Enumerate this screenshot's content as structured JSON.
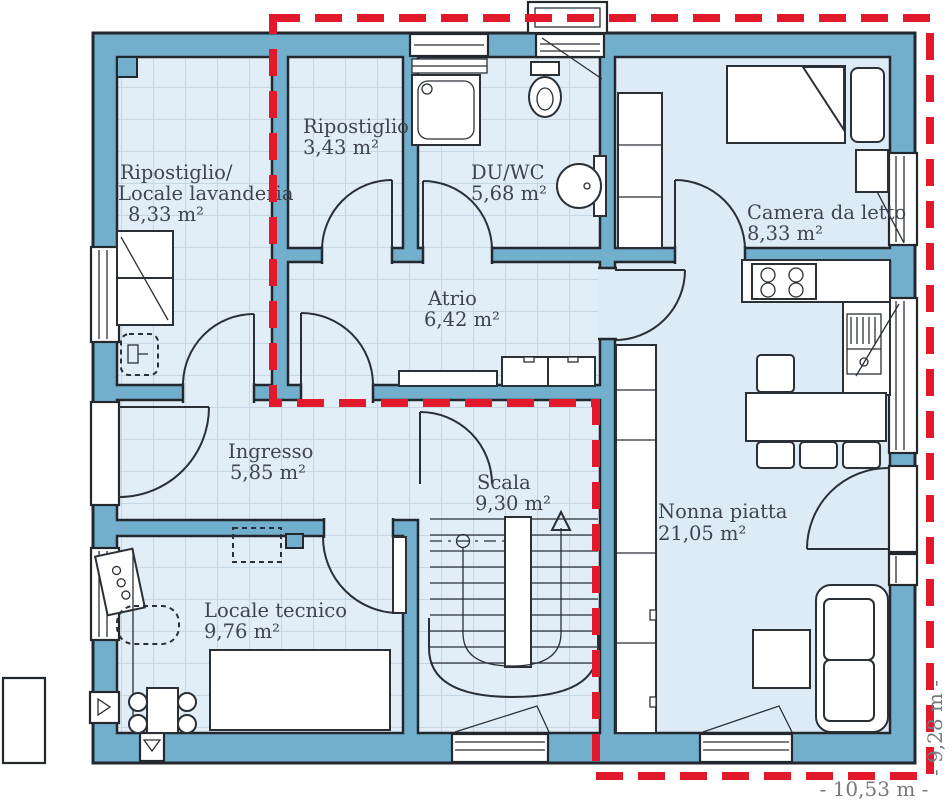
{
  "plan": {
    "type": "residential floor plan",
    "rooms": [
      {
        "id": "laundry",
        "name_line1": "Ripostiglio/",
        "name_line2": "Locale lavanderia",
        "area": "8,33 m²"
      },
      {
        "id": "storage",
        "name": "Ripostiglio",
        "area": "3,43 m²"
      },
      {
        "id": "shower-wc",
        "name": "DU/WC",
        "area": "5,68 m²"
      },
      {
        "id": "bedroom",
        "name": "Camera da letto",
        "area": "8,33 m²"
      },
      {
        "id": "atrium",
        "name": "Atrio",
        "area": "6,42 m²"
      },
      {
        "id": "entrance",
        "name": "Ingresso",
        "area": "5,85 m²"
      },
      {
        "id": "stairs",
        "name": "Scala",
        "area": "9,30 m²"
      },
      {
        "id": "utility",
        "name": "Locale tecnico",
        "area": "9,76 m²"
      },
      {
        "id": "granny-flat",
        "name": "Nonna piatta",
        "area": "21,05 m²"
      }
    ],
    "dimensions": {
      "width_label": "- 10,53 m -",
      "height_label": "- 9,28 m -"
    },
    "boundary": {
      "style": "red dashed",
      "meaning": "unit outline"
    }
  },
  "colors": {
    "wall": "#72afcd",
    "outline": "#23272e",
    "room_fill": "#ddebf6",
    "tile_line": "#c6d6e4",
    "boundary_red": "#e2182b",
    "label_text": "#3f4450",
    "dimension_text": "#75787f"
  }
}
